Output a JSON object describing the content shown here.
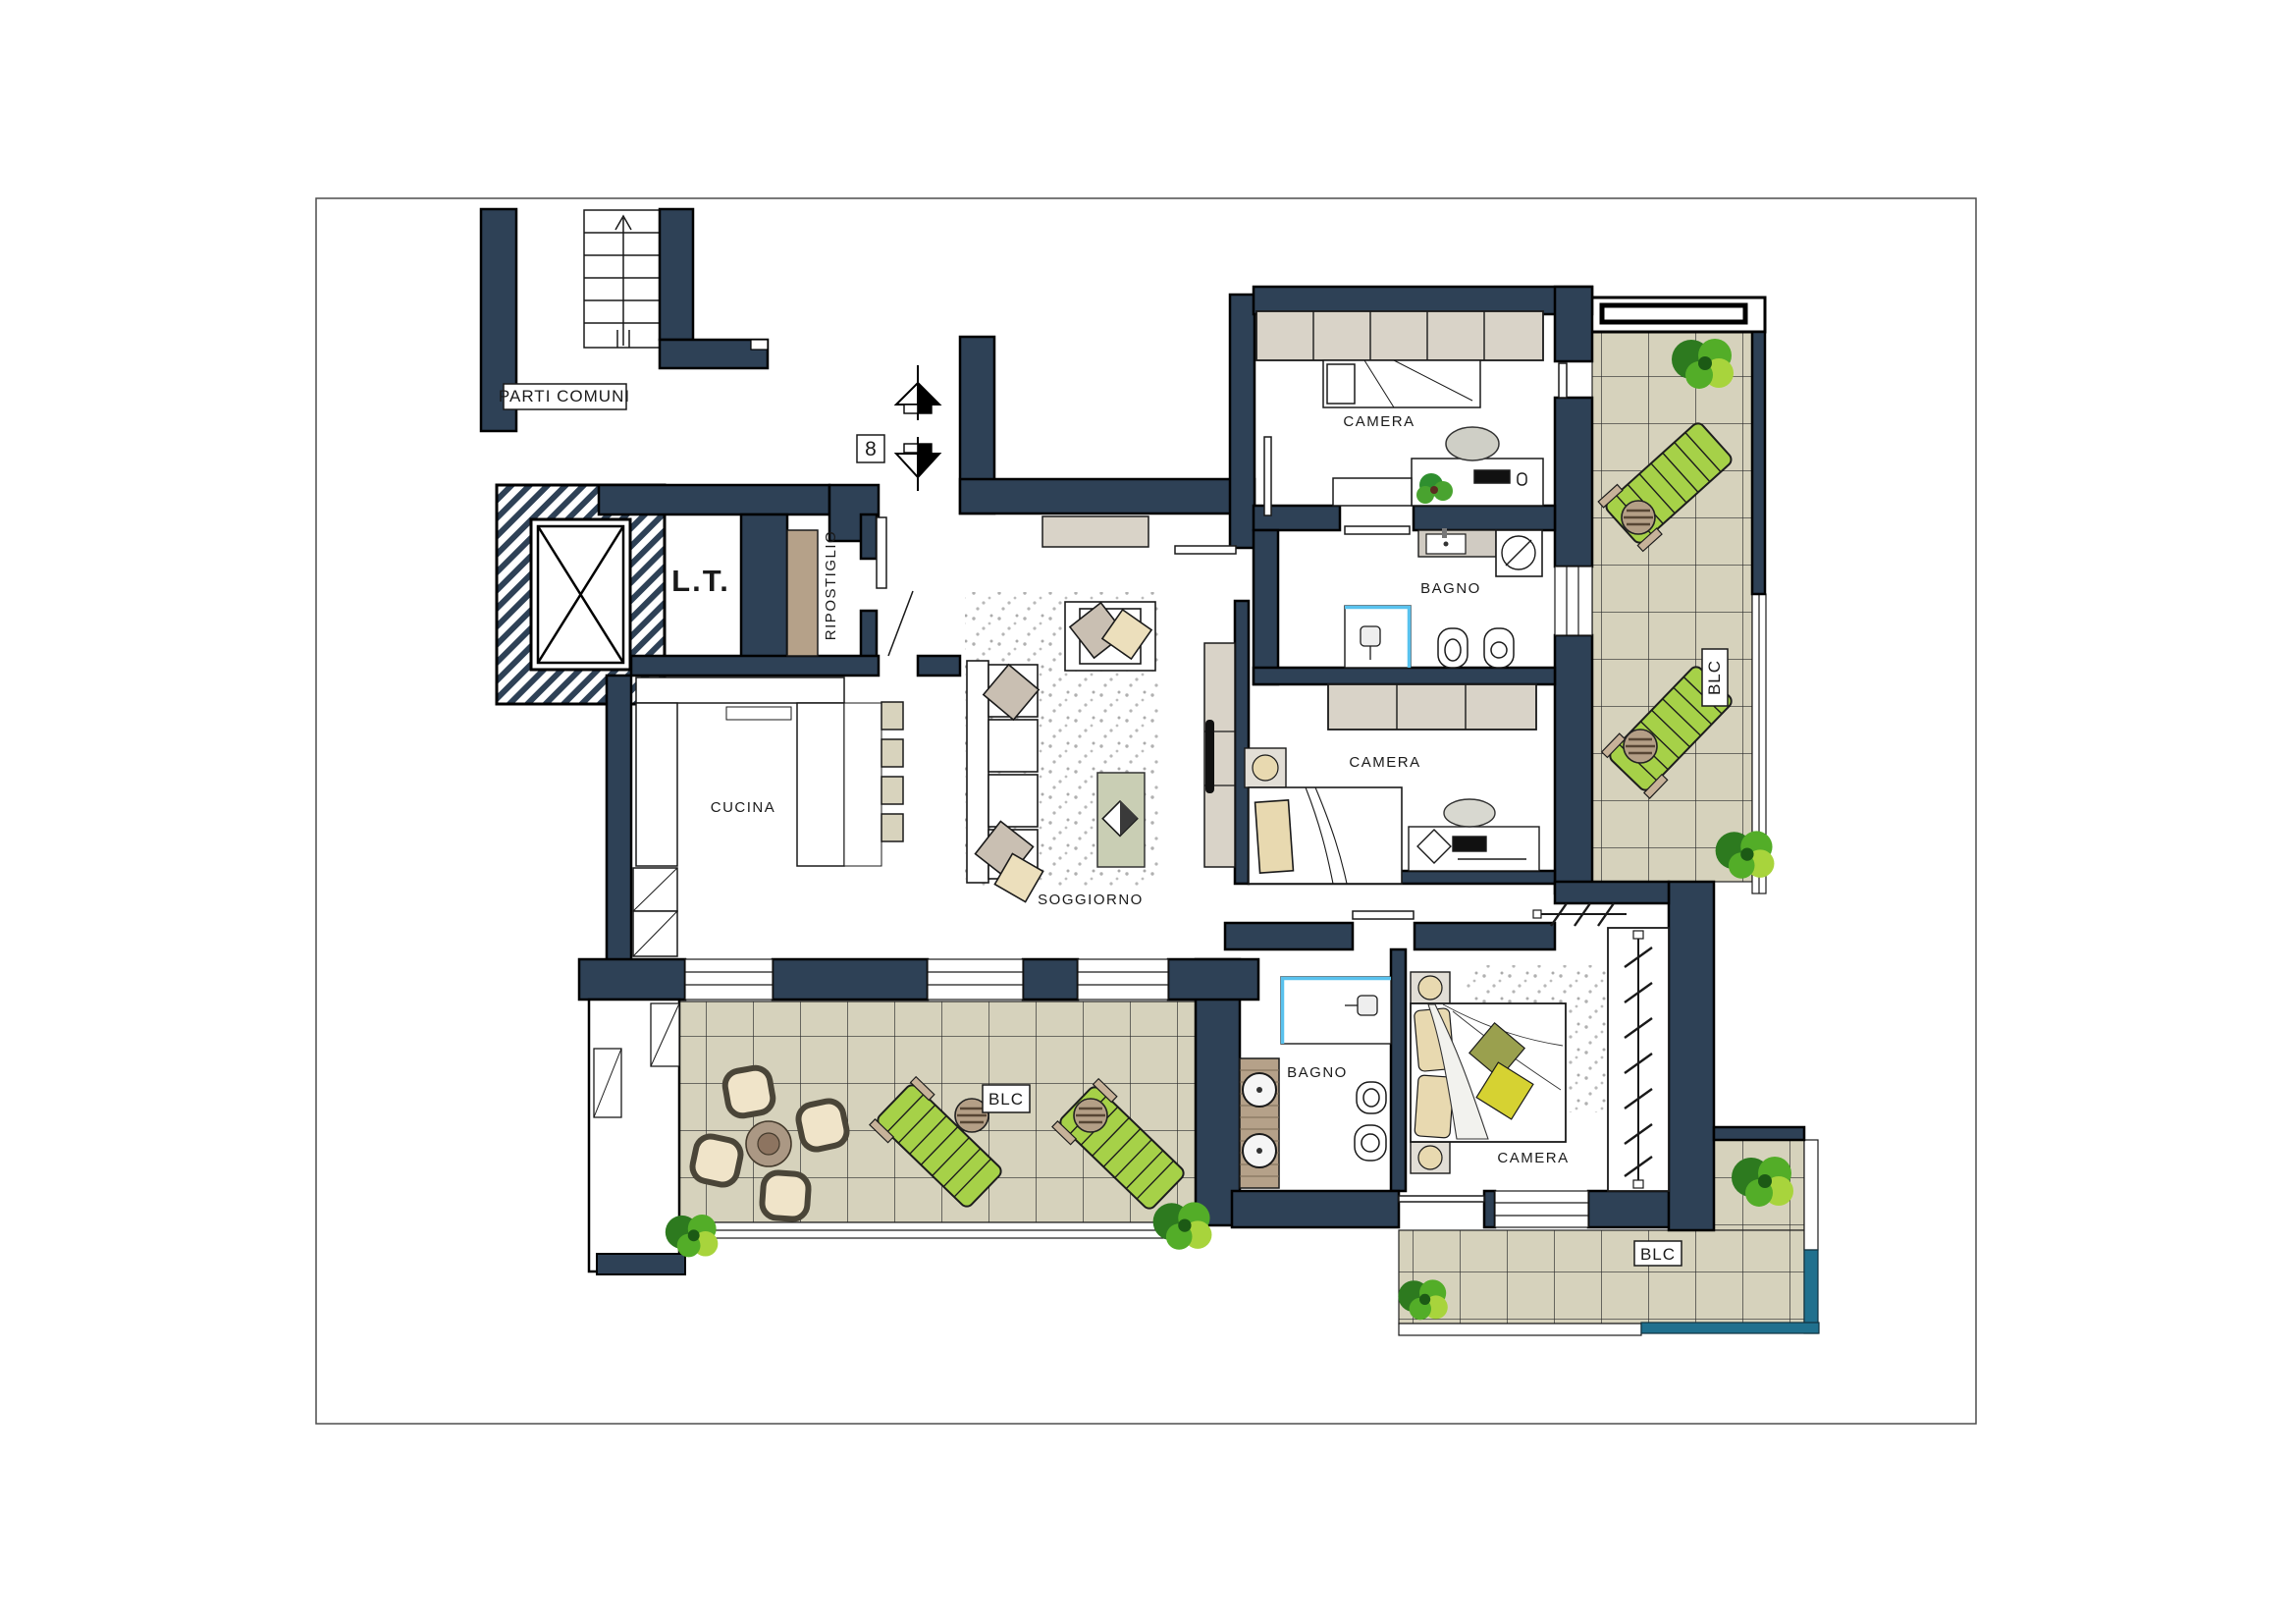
{
  "document": {
    "kind": "architectural floor plan",
    "unit": "apartment 8"
  },
  "labels": {
    "parti_comuni": "PARTI COMUNI",
    "unit_number": "8",
    "lt_room": "L.T.",
    "ripostiglio": "RIPOSTIGLIO",
    "cucina": "CUCINA",
    "soggiorno": "SOGGIORNO",
    "camera_top": "CAMERA",
    "camera_middle": "CAMERA",
    "camera_master": "CAMERA",
    "bagno_top": "BAGNO",
    "bagno_lower": "BAGNO",
    "blc_right": "BLC",
    "blc_bottom_left": "BLC",
    "blc_bottom_right": "BLC"
  },
  "colors": {
    "wall": "#2e4156",
    "tile_floor": "#d6d2bc",
    "lounger_green": "#a6d148",
    "wood_counter": "#b5a189",
    "wardrobe_beige": "#d9d3c8",
    "ripostiglio_wardrobe_tan": "#b5a189",
    "coffee_table": "#c9ceb4",
    "cushion_gray": "#c9bfb2",
    "cushion_cream": "#ecdfbc",
    "cushion_olive": "#9aa04e",
    "cushion_yellow": "#d6d232",
    "railing_teal": "#20708e",
    "shower_blue": "#59c2ee",
    "stool_beige": "#d8d3bd",
    "bush_dark": "#2d7a1f",
    "bush_mid": "#53ad28",
    "bush_light": "#a8d43c"
  },
  "icons": {
    "compass_up": "north-arrow-icon",
    "compass_down": "south-arrow-icon",
    "stairs": "staircase-icon",
    "elevator": "elevator-shaft-icon",
    "washing_machine": "washing-machine-icon",
    "shower": "shower-icon",
    "toilet": "toilet-icon",
    "bidet": "bidet-icon",
    "sink": "sink-icon",
    "bed": "bed-icon",
    "sofa": "sofa-icon",
    "armchair": "armchair-icon",
    "lounger": "sun-lounger-icon",
    "bush": "shrub-icon",
    "dining_set": "outdoor-dining-set-icon",
    "wardrobe_rail": "closet-rail-icon"
  }
}
